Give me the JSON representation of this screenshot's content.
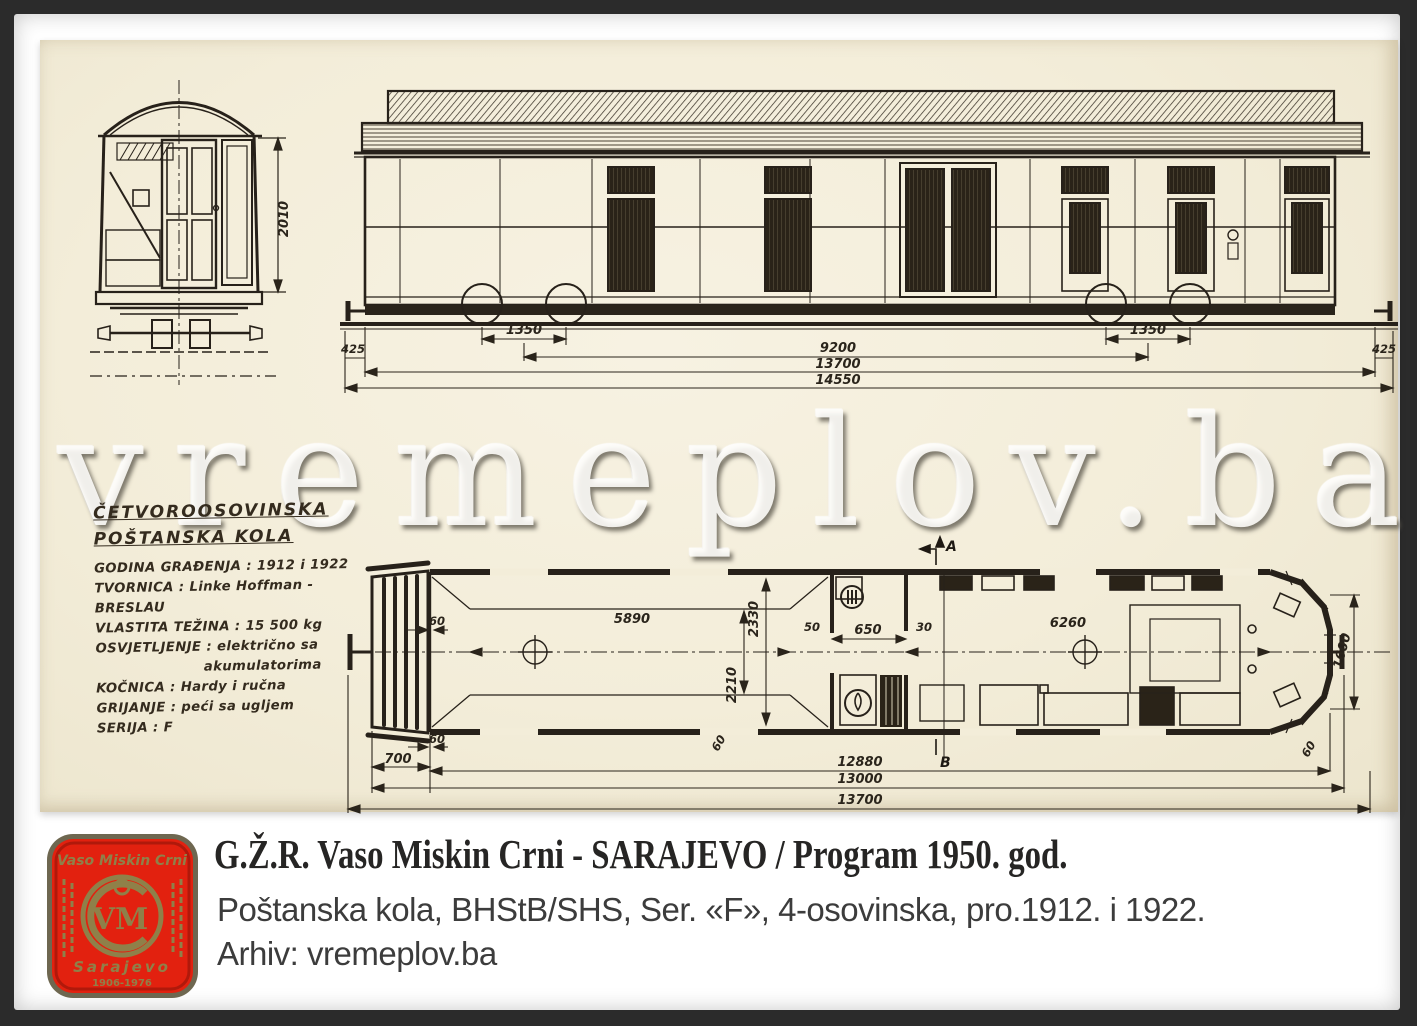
{
  "colors": {
    "frame": "#2b2b2b",
    "paper": "#f3edd9",
    "ink": "#27211a",
    "logo_red": "#e2210f",
    "logo_gold": "#97874d"
  },
  "scan": {
    "watermark": "vremeplov.ba",
    "specs": {
      "title1": "ČETVOROOSOVINSKA",
      "title2": "POŠTANSKA KOLA",
      "lines": [
        "GODINA GRAĐENJA : 1912 i 1922",
        "TVORNICA : Linke Hoffman - BRESLAU",
        "VLASTITA TEŽINA : 15 500 kg",
        "OSVJETLJENJE : električno sa",
        "akumulatorima",
        "KOČNICA : Hardy i ručna",
        "GRIJANJE : peći sa ugljem",
        "SERIJA : F"
      ]
    },
    "end_view": {
      "dims": {
        "body_height": "2010"
      }
    },
    "side_view": {
      "dims": {
        "overhang_left": "425",
        "bogie_left": "1350",
        "bogie_centers": "9200",
        "bogie_right": "1350",
        "overhang_right": "425",
        "frame_length": "13700",
        "overall_length": "14550"
      }
    },
    "plan_view": {
      "dims": {
        "wall": "60",
        "platform": "700",
        "comp_left": "5890",
        "width_outer": "2330",
        "width_inner": "2210",
        "d50": "50",
        "door": "650",
        "d30": "30",
        "comp_right": "6260",
        "end_width": "1600",
        "inner_length": "12880",
        "body_length": "13000",
        "total_length": "13700"
      },
      "sections": {
        "a": "A",
        "b": "B"
      }
    }
  },
  "caption": {
    "logo": {
      "top": "Vaso Miskin Crni",
      "monogram": "VM",
      "city": "Sarajevo",
      "years": "1906-1976"
    },
    "title": "G.Ž.R. Vaso Miskin Crni - SARAJEVO / Program 1950. god.",
    "line1": "Poštanska kola, BHStB/SHS, Ser. «F», 4-osovinska, pro.1912. i 1922.",
    "line2": "Arhiv: vremeplov.ba"
  }
}
